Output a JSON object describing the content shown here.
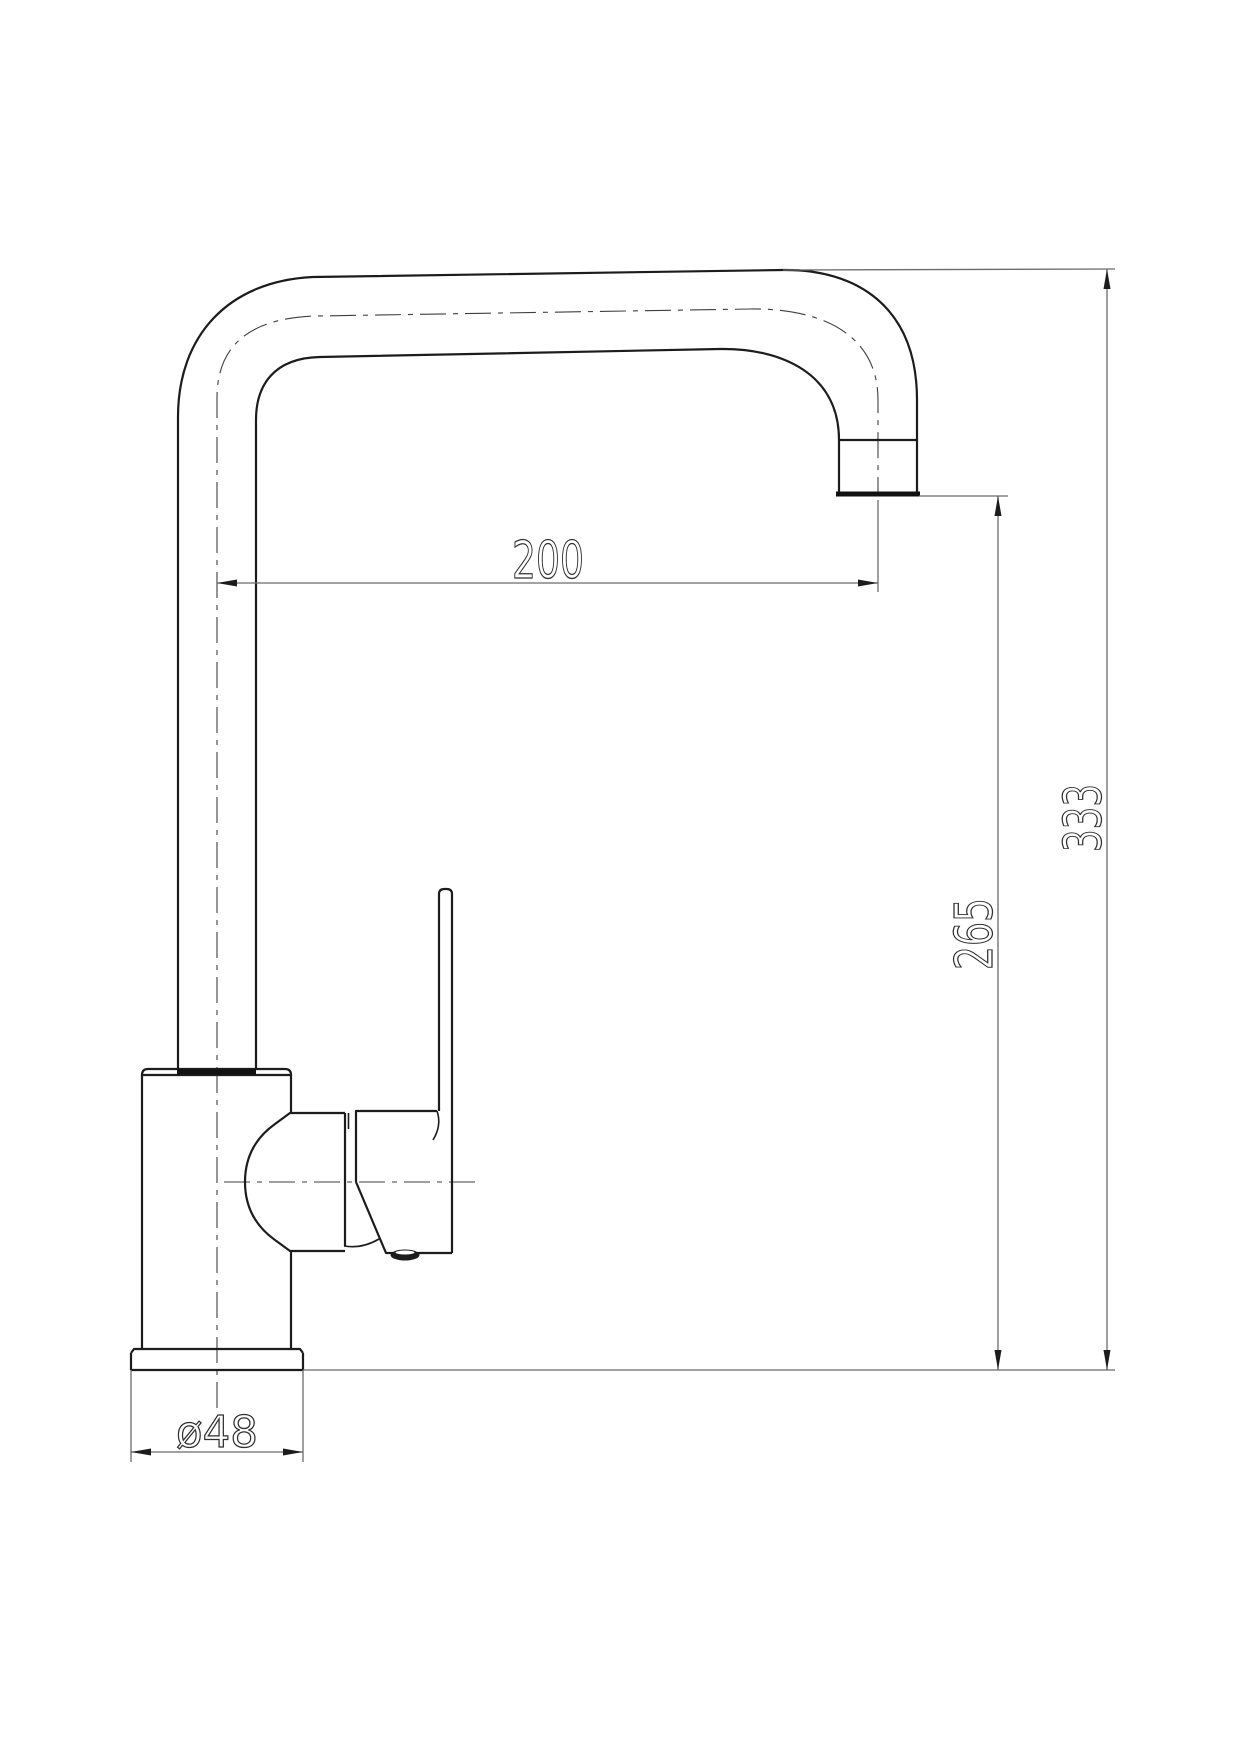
{
  "drawing": {
    "subject": "single-lever kitchen mixer tap, side elevation, dimensioned line drawing",
    "units": "mm",
    "background_color": "#ffffff",
    "dimensions": [
      {
        "id": "spout-reach",
        "label": "200",
        "value": 200,
        "orientation": "horizontal"
      },
      {
        "id": "outlet-height",
        "label": "265",
        "value": 265,
        "orientation": "vertical"
      },
      {
        "id": "overall-height",
        "label": "333",
        "value": 333,
        "orientation": "vertical"
      },
      {
        "id": "base-diameter",
        "label": "ø48",
        "value": 48,
        "orientation": "horizontal"
      }
    ],
    "colors": {
      "object_line": "#1c1c1c",
      "dimension_line": "#6b6b6b",
      "centerline": "#3f3f3f",
      "text": "#2f2f2f"
    }
  }
}
